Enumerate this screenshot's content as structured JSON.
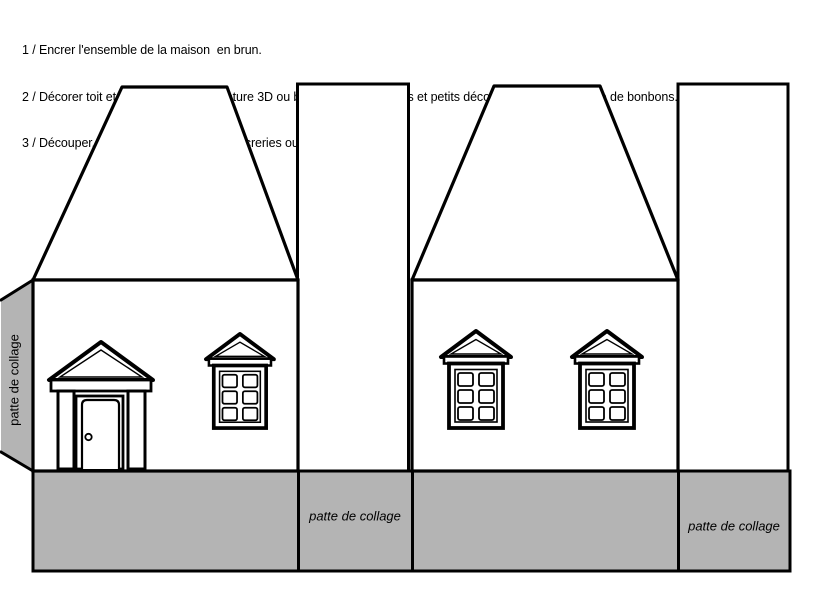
{
  "colors": {
    "background": "#ffffff",
    "line_ink": "#000000",
    "glue_tab_gray": "#b4b4b4"
  },
  "instructions": {
    "line1": "1 / Encrer l'ensemble de la maison  en brun.",
    "line2": "2 / Décorer toit et murs avec de la peinture 3D ou bien coller gommettes et petits décors de papier en forme de bonbons.",
    "line3": "3 / Découper, plier, coller et remplir de sucreries ou petits cadeaux."
  },
  "glue_tab_labels": {
    "left_vertical": "patte de collage",
    "middle": "patte de collage",
    "right": "patte de collage"
  }
}
